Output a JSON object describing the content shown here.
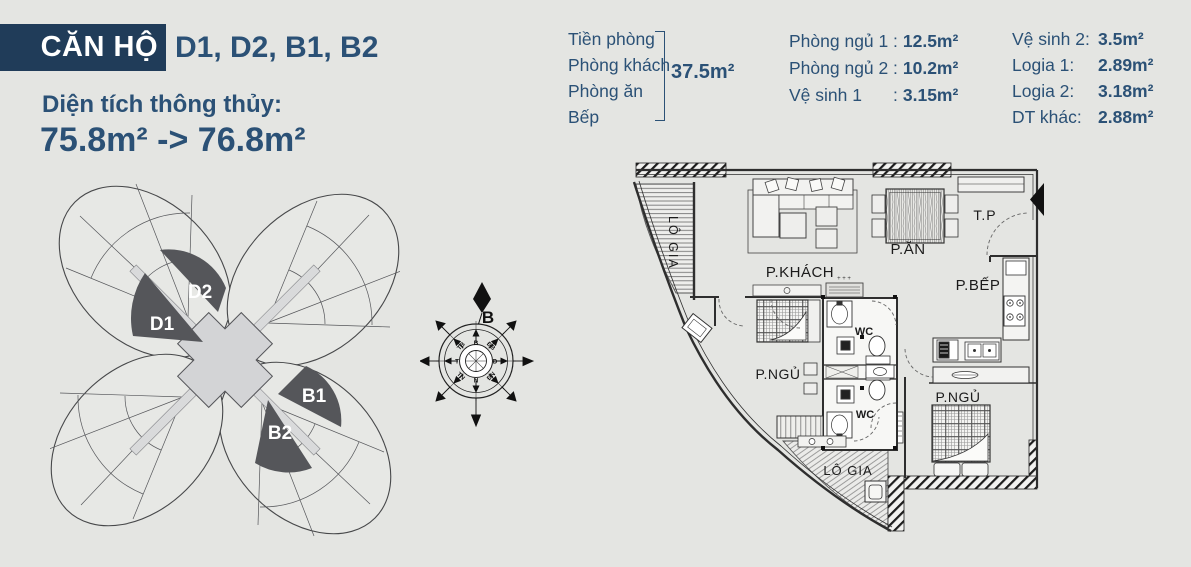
{
  "theme": {
    "background": "#e4e5e2",
    "navy_box": "#203c59",
    "navy_text": "#2b5176",
    "unit_fill": "#55565a",
    "plan_line": "#2e2e2e"
  },
  "header": {
    "apartment_label": "CĂN HỘ",
    "apartment_units": "D1, D2, B1, B2",
    "area_title": "Diện tích thông thủy:",
    "area_range": "75.8m² -> 76.8m²"
  },
  "area_breakdown": {
    "grouped_rooms": {
      "rooms": [
        "Tiền phòng",
        "Phòng khách",
        "Phòng ăn",
        "Bếp"
      ],
      "total": "37.5m²"
    },
    "column2": [
      {
        "label": "Phòng ngủ 1",
        "value": "12.5m²"
      },
      {
        "label": "Phòng ngủ 2",
        "value": "10.2m²"
      },
      {
        "label": "Vệ sinh 1",
        "value": "3.15m²"
      }
    ],
    "column3": [
      {
        "label": "Vệ sinh 2:",
        "value": "3.5m²"
      },
      {
        "label": "Logia 1:",
        "value": "2.89m²"
      },
      {
        "label": "Logia 2:",
        "value": "3.18m²"
      },
      {
        "label": "DT khác:",
        "value": "2.88m²"
      }
    ]
  },
  "site_plan": {
    "units": [
      {
        "id": "D2"
      },
      {
        "id": "D1"
      },
      {
        "id": "B1"
      },
      {
        "id": "B2"
      }
    ]
  },
  "compass": {
    "north": "B",
    "directions": [
      "B",
      "ĐB",
      "Đ",
      "ĐN",
      "N",
      "TN",
      "T",
      "TB"
    ]
  },
  "floor_plan": {
    "rooms": [
      "LÔ GIA",
      "P.KHÁCH",
      "P.ĂN",
      "T.P",
      "P.BẾP",
      "WC",
      "WC",
      "P.NGỦ",
      "P.NGỦ",
      "LÔ GIA"
    ]
  }
}
